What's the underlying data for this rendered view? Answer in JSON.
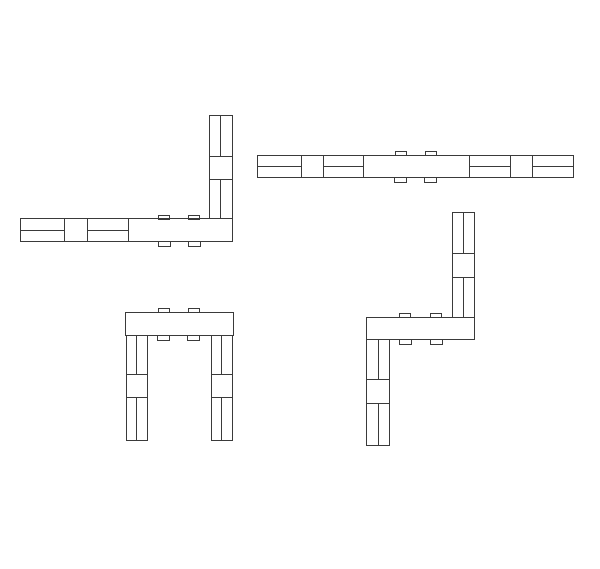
{
  "canvas": {
    "width": 600,
    "height": 569,
    "background_color": "#ffffff",
    "line_color": "#3a3a3a",
    "line_width": 1
  },
  "drawing": {
    "figures": [
      {
        "name": "corner-view-top-left",
        "parts": [
          {
            "type": "rect",
            "name": "beam",
            "x": 20,
            "y": 218,
            "w": 212,
            "h": 23
          },
          {
            "type": "rect",
            "name": "post",
            "x": 209,
            "y": 115,
            "w": 23,
            "h": 103
          },
          {
            "type": "rect",
            "name": "peg-tab-top-1",
            "x": 158,
            "y": 215,
            "w": 11,
            "h": 4
          },
          {
            "type": "rect",
            "name": "peg-tab-top-2",
            "x": 188,
            "y": 215,
            "w": 11,
            "h": 4
          },
          {
            "type": "rect",
            "name": "peg-tab-bottom-1",
            "x": 158,
            "y": 241,
            "w": 12,
            "h": 5
          },
          {
            "type": "rect",
            "name": "peg-tab-bottom-2",
            "x": 188,
            "y": 241,
            "w": 12,
            "h": 5
          },
          {
            "type": "line",
            "name": "beam-divider-1",
            "x1": 64,
            "y1": 218,
            "x2": 64,
            "y2": 241
          },
          {
            "type": "line",
            "name": "beam-divider-2",
            "x1": 87,
            "y1": 218,
            "x2": 87,
            "y2": 241
          },
          {
            "type": "line",
            "name": "beam-divider-3",
            "x1": 128,
            "y1": 218,
            "x2": 128,
            "y2": 241
          },
          {
            "type": "line",
            "name": "beam-center-rail-1",
            "x1": 20,
            "y1": 230,
            "x2": 64,
            "y2": 230
          },
          {
            "type": "line",
            "name": "beam-center-rail-2",
            "x1": 87,
            "y1": 230,
            "x2": 128,
            "y2": 230
          },
          {
            "type": "line",
            "name": "post-divider-1",
            "x1": 209,
            "y1": 156,
            "x2": 232,
            "y2": 156
          },
          {
            "type": "line",
            "name": "post-divider-2",
            "x1": 209,
            "y1": 179,
            "x2": 232,
            "y2": 179
          },
          {
            "type": "line",
            "name": "post-center-rail-1",
            "x1": 220,
            "y1": 115,
            "x2": 220,
            "y2": 156
          },
          {
            "type": "line",
            "name": "post-center-rail-2",
            "x1": 220,
            "y1": 179,
            "x2": 220,
            "y2": 218
          }
        ]
      },
      {
        "name": "long-beam-view-top-right",
        "parts": [
          {
            "type": "rect",
            "name": "beam",
            "x": 257,
            "y": 155,
            "w": 316,
            "h": 22
          },
          {
            "type": "rect",
            "name": "peg-tab-top-1",
            "x": 395,
            "y": 151,
            "w": 11,
            "h": 4
          },
          {
            "type": "rect",
            "name": "peg-tab-top-2",
            "x": 425,
            "y": 151,
            "w": 11,
            "h": 4
          },
          {
            "type": "rect",
            "name": "peg-tab-bottom-1",
            "x": 394,
            "y": 177,
            "w": 12,
            "h": 5
          },
          {
            "type": "rect",
            "name": "peg-tab-bottom-2",
            "x": 424,
            "y": 177,
            "w": 12,
            "h": 5
          },
          {
            "type": "line",
            "name": "beam-divider-1",
            "x1": 301,
            "y1": 155,
            "x2": 301,
            "y2": 177
          },
          {
            "type": "line",
            "name": "beam-divider-2",
            "x1": 323,
            "y1": 155,
            "x2": 323,
            "y2": 177
          },
          {
            "type": "line",
            "name": "beam-divider-3",
            "x1": 363,
            "y1": 155,
            "x2": 363,
            "y2": 177
          },
          {
            "type": "line",
            "name": "beam-divider-4",
            "x1": 469,
            "y1": 155,
            "x2": 469,
            "y2": 177
          },
          {
            "type": "line",
            "name": "beam-divider-5",
            "x1": 510,
            "y1": 155,
            "x2": 510,
            "y2": 177
          },
          {
            "type": "line",
            "name": "beam-divider-6",
            "x1": 532,
            "y1": 155,
            "x2": 532,
            "y2": 177
          },
          {
            "type": "line",
            "name": "beam-center-rail-1",
            "x1": 257,
            "y1": 166,
            "x2": 301,
            "y2": 166
          },
          {
            "type": "line",
            "name": "beam-center-rail-2",
            "x1": 323,
            "y1": 166,
            "x2": 363,
            "y2": 166
          },
          {
            "type": "line",
            "name": "beam-center-rail-3",
            "x1": 469,
            "y1": 166,
            "x2": 510,
            "y2": 166
          },
          {
            "type": "line",
            "name": "beam-center-rail-4",
            "x1": 532,
            "y1": 166,
            "x2": 573,
            "y2": 166
          }
        ]
      },
      {
        "name": "front-view-bottom-left",
        "parts": [
          {
            "type": "rect",
            "name": "top-beam",
            "x": 125,
            "y": 312,
            "w": 108,
            "h": 23
          },
          {
            "type": "rect",
            "name": "left-leg",
            "x": 126,
            "y": 335,
            "w": 21,
            "h": 105
          },
          {
            "type": "rect",
            "name": "right-leg",
            "x": 211,
            "y": 335,
            "w": 21,
            "h": 105
          },
          {
            "type": "rect",
            "name": "peg-tab-top-1",
            "x": 158,
            "y": 308,
            "w": 11,
            "h": 4
          },
          {
            "type": "rect",
            "name": "peg-tab-top-2",
            "x": 188,
            "y": 308,
            "w": 11,
            "h": 4
          },
          {
            "type": "rect",
            "name": "peg-tab-bottom-1",
            "x": 157,
            "y": 335,
            "w": 12,
            "h": 5
          },
          {
            "type": "rect",
            "name": "peg-tab-bottom-2",
            "x": 187,
            "y": 335,
            "w": 12,
            "h": 5
          },
          {
            "type": "line",
            "name": "left-leg-divider-1",
            "x1": 126,
            "y1": 374,
            "x2": 147,
            "y2": 374
          },
          {
            "type": "line",
            "name": "left-leg-divider-2",
            "x1": 126,
            "y1": 397,
            "x2": 147,
            "y2": 397
          },
          {
            "type": "line",
            "name": "left-leg-center-rail-1",
            "x1": 136,
            "y1": 335,
            "x2": 136,
            "y2": 374
          },
          {
            "type": "line",
            "name": "left-leg-center-rail-2",
            "x1": 136,
            "y1": 397,
            "x2": 136,
            "y2": 440
          },
          {
            "type": "line",
            "name": "right-leg-divider-1",
            "x1": 211,
            "y1": 374,
            "x2": 232,
            "y2": 374
          },
          {
            "type": "line",
            "name": "right-leg-divider-2",
            "x1": 211,
            "y1": 397,
            "x2": 232,
            "y2": 397
          },
          {
            "type": "line",
            "name": "right-leg-center-rail-1",
            "x1": 221,
            "y1": 335,
            "x2": 221,
            "y2": 374
          },
          {
            "type": "line",
            "name": "right-leg-center-rail-2",
            "x1": 221,
            "y1": 397,
            "x2": 221,
            "y2": 440
          }
        ]
      },
      {
        "name": "side-view-bottom-right",
        "parts": [
          {
            "type": "rect",
            "name": "seat-beam",
            "x": 366,
            "y": 317,
            "w": 108,
            "h": 22
          },
          {
            "type": "rect",
            "name": "back-post",
            "x": 452,
            "y": 212,
            "w": 22,
            "h": 105
          },
          {
            "type": "rect",
            "name": "front-leg",
            "x": 366,
            "y": 339,
            "w": 23,
            "h": 106
          },
          {
            "type": "rect",
            "name": "peg-tab-top-1",
            "x": 399,
            "y": 313,
            "w": 11,
            "h": 4
          },
          {
            "type": "rect",
            "name": "peg-tab-top-2",
            "x": 430,
            "y": 313,
            "w": 11,
            "h": 4
          },
          {
            "type": "rect",
            "name": "peg-tab-bottom-1",
            "x": 399,
            "y": 339,
            "w": 12,
            "h": 5
          },
          {
            "type": "rect",
            "name": "peg-tab-bottom-2",
            "x": 430,
            "y": 339,
            "w": 12,
            "h": 5
          },
          {
            "type": "line",
            "name": "back-post-divider-1",
            "x1": 452,
            "y1": 253,
            "x2": 474,
            "y2": 253
          },
          {
            "type": "line",
            "name": "back-post-divider-2",
            "x1": 452,
            "y1": 277,
            "x2": 474,
            "y2": 277
          },
          {
            "type": "line",
            "name": "back-post-center-rail-1",
            "x1": 463,
            "y1": 212,
            "x2": 463,
            "y2": 253
          },
          {
            "type": "line",
            "name": "back-post-center-rail-2",
            "x1": 463,
            "y1": 277,
            "x2": 463,
            "y2": 317
          },
          {
            "type": "line",
            "name": "front-leg-divider-1",
            "x1": 366,
            "y1": 379,
            "x2": 389,
            "y2": 379
          },
          {
            "type": "line",
            "name": "front-leg-divider-2",
            "x1": 366,
            "y1": 403,
            "x2": 389,
            "y2": 403
          },
          {
            "type": "line",
            "name": "front-leg-center-rail-1",
            "x1": 378,
            "y1": 339,
            "x2": 378,
            "y2": 379
          },
          {
            "type": "line",
            "name": "front-leg-center-rail-2",
            "x1": 378,
            "y1": 403,
            "x2": 378,
            "y2": 445
          }
        ]
      }
    ]
  }
}
